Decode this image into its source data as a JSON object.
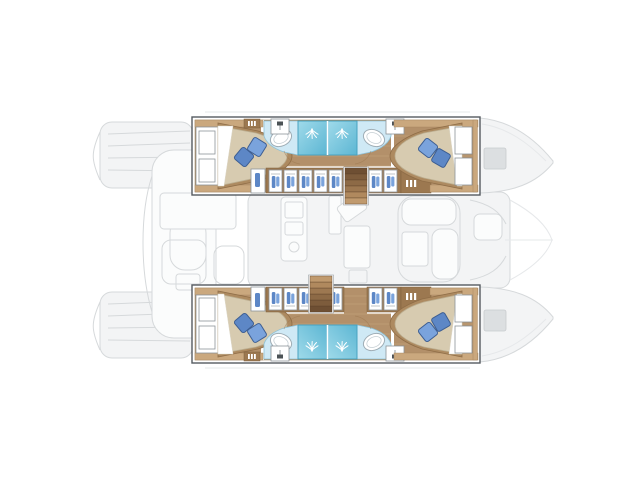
{
  "image": {
    "description": "Catamaran yacht deck layout plan, top view, bow to the right",
    "width": 640,
    "height": 479
  },
  "labels": {
    "plan": "Catamaran deck plan with four cabins highlighted",
    "port_hull": "Port hull accommodation",
    "starboard_hull": "Starboard hull accommodation",
    "aft_cabin": "Aft double cabin",
    "forward_cabin": "Forward double cabin",
    "bathroom": "Bathroom with twin shower stalls",
    "shower": "Shower stall",
    "sink": "Washbasin",
    "toilet": "WC unit",
    "wardrobe": "Wardrobe locker",
    "cabinet": "Storage cabinet",
    "bed": "Double berth with pillows",
    "window": "Hull window panel",
    "stairs": "Companionway stairs",
    "saloon": "Saloon deck (faded)",
    "galley": "Galley (faded)",
    "sofa": "Saloon sofa (faded)",
    "cockpit": "Aft cockpit (faded)",
    "cockpit_table": "Cockpit table (faded)",
    "stern_platform": "Stern swim platform (faded)",
    "bow": "Hull bow (faded)",
    "bow_hatch": "Bow deck hatch",
    "trampoline": "Bow trampoline (faded)"
  },
  "counts": {
    "hulls": 2,
    "cabins": 4,
    "beds": 4,
    "pillows": 8,
    "shower_stalls": 4,
    "sinks": 4,
    "staircases": 2,
    "bow_hatches": 2
  },
  "colors": {
    "bg": "#ffffff",
    "faded-fill": "#f3f4f5",
    "faded-stroke": "#d6d9db",
    "faded-dark": "#dcdfe1",
    "hull-outline": "#565b60",
    "wood": "#b3906a",
    "wood-grain": "#c9a77e",
    "wood-dark": "#9c7850",
    "trim": "#caa87e",
    "bedframe": "#ad8a60",
    "mattress": "#d7cbb0",
    "mattress-edge": "#bcae90",
    "pillow-dark": "#5d87c6",
    "pillow-light": "#7aa3dc",
    "pillow-stroke": "#3d5e92",
    "shower-light": "#9fdaea",
    "shower-deep": "#5cb6d3",
    "shower-stroke": "#48a2c0",
    "counter": "#cfe9f5",
    "counter-stroke": "#8fc2d8",
    "unit-stroke": "#8d9499"
  }
}
